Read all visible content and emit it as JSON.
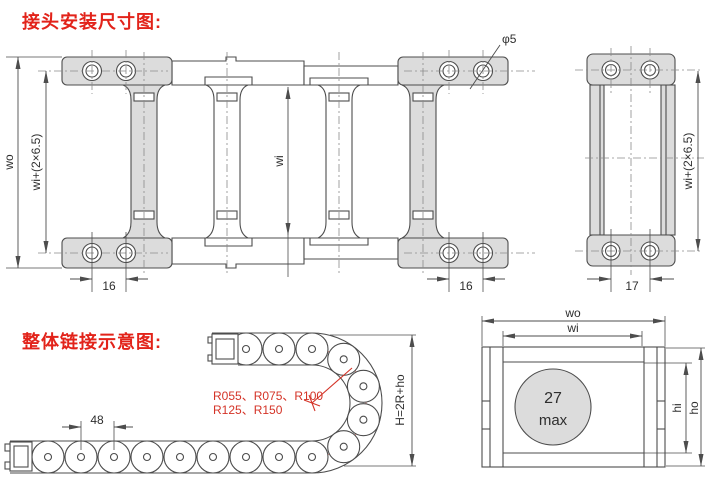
{
  "titles": {
    "installation": "接头安装尺寸图:",
    "assembly": "整体链接示意图:"
  },
  "plan_view": {
    "wo": "wo",
    "wi_plus": "wi+(2×6.5)",
    "wi": "wi",
    "pitch_left": "16",
    "pitch_right": "16",
    "hole_dia": "φ5"
  },
  "end_view": {
    "wi_plus": "wi+(2×6.5)",
    "pitch": "17"
  },
  "bend_view": {
    "pitch": "48",
    "radii_1": "R055、R075、R100",
    "radii_2": "R125、R150",
    "height": "H=2R+ho"
  },
  "section_view": {
    "wo": "wo",
    "wi": "wi",
    "bore_1": "27",
    "bore_2": "max",
    "hi": "hi",
    "ho": "ho"
  },
  "colors": {
    "accent_red": "#e2231a",
    "red_centerline": "#e07b70",
    "drawing_line": "#4d4d4d",
    "plate_fill": "#dcdcdc"
  }
}
